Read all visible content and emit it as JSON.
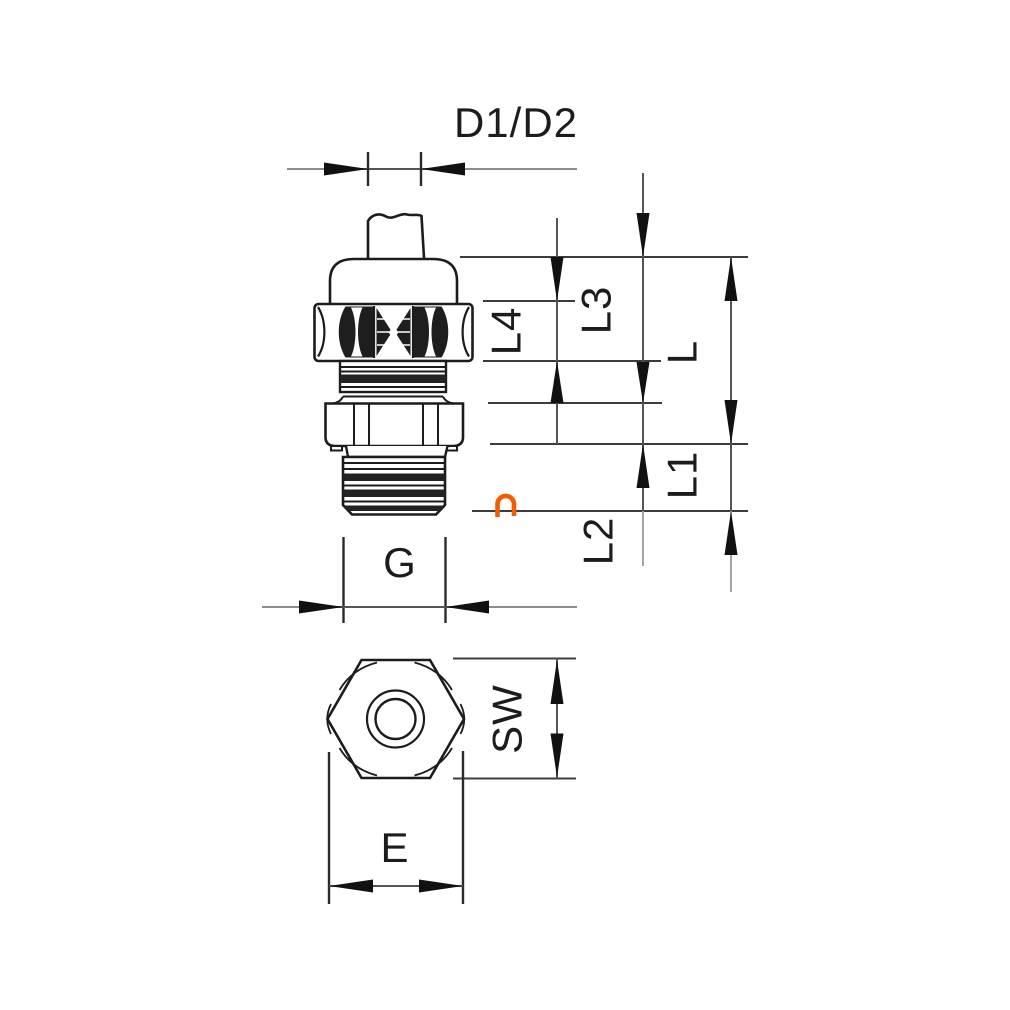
{
  "drawing": {
    "type": "technical-dimension-drawing",
    "subject": "cable-gland",
    "background_color": "#ffffff",
    "line_color": "#1c1c1c",
    "dim_line_color": "#555555",
    "faded_line_color": "#9a9a9a",
    "accent_color": "#f25c05"
  },
  "dimensions": {
    "d1_d2": "D1/D2",
    "l3": "L3",
    "l4": "L4",
    "l": "L",
    "l1": "L1",
    "l2": "L2",
    "g": "G",
    "sw": "SW",
    "e": "E"
  },
  "watermark": {
    "glyph": "n",
    "color": "#f25c05"
  }
}
